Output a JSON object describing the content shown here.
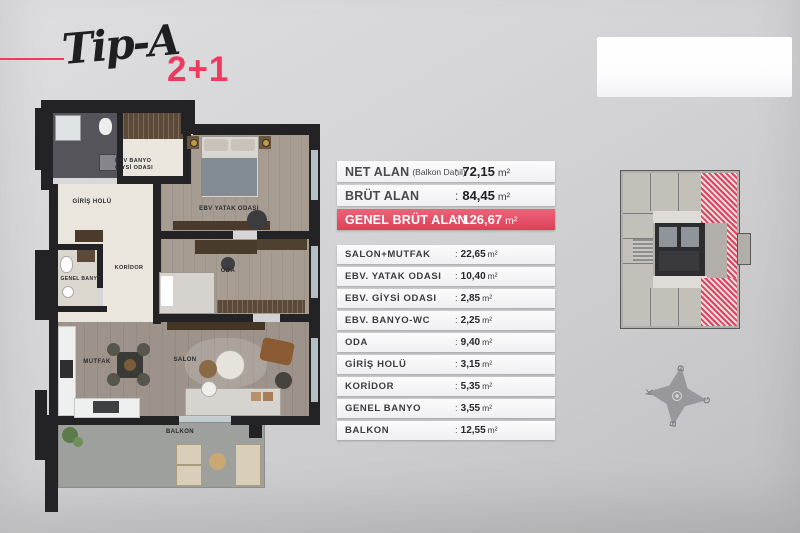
{
  "header": {
    "type_label": "Tip-A",
    "unit_type": "2+1",
    "accent_color": "#ed3a5e"
  },
  "colon": ":",
  "summary_table": {
    "rows": [
      {
        "label": "NET ALAN",
        "note": "(Balkon Dahil)",
        "value": "72,15",
        "unit": "m²",
        "highlight": false
      },
      {
        "label": "BRÜT ALAN",
        "note": "",
        "value": "84,45",
        "unit": "m²",
        "highlight": false
      },
      {
        "label": "GENEL BRÜT ALAN",
        "note": "",
        "value": "126,67",
        "unit": "m²",
        "highlight": true
      }
    ]
  },
  "room_table": {
    "rows": [
      {
        "label": "SALON+MUTFAK",
        "value": "22,65",
        "unit": "m²"
      },
      {
        "label": "EBV. YATAK ODASI",
        "value": "10,40",
        "unit": "m²"
      },
      {
        "label": "EBV. GİYSİ ODASI",
        "value": "2,85",
        "unit": "m²"
      },
      {
        "label": "EBV. BANYO-WC",
        "value": "2,25",
        "unit": "m²"
      },
      {
        "label": "ODA",
        "value": "9,40",
        "unit": "m²"
      },
      {
        "label": "GİRİŞ HOLÜ",
        "value": "3,15",
        "unit": "m²"
      },
      {
        "label": "KORİDOR",
        "value": "5,35",
        "unit": "m²"
      },
      {
        "label": "GENEL BANYO",
        "value": "3,55",
        "unit": "m²"
      },
      {
        "label": "BALKON",
        "value": "12,55",
        "unit": "m²"
      }
    ]
  },
  "floor_plan": {
    "labels": {
      "ebv_banyo": "EBV BANYO",
      "giysi_odasi": "GİYSİ ODASI",
      "giris_holu": "GİRİŞ HOLÜ",
      "ebv_yatak_odasi": "EBV YATAK ODASI",
      "koridor": "KORİDOR",
      "genel_banyo": "GENEL BANYO",
      "oda": "ODA",
      "mutfak": "MUTFAK",
      "salon": "SALON",
      "balkon": "BALKON"
    }
  },
  "key_plan": {
    "highlight_color": "#d8475e"
  },
  "compass": {
    "north": "K",
    "east": "D",
    "south": "G",
    "west": "B"
  }
}
